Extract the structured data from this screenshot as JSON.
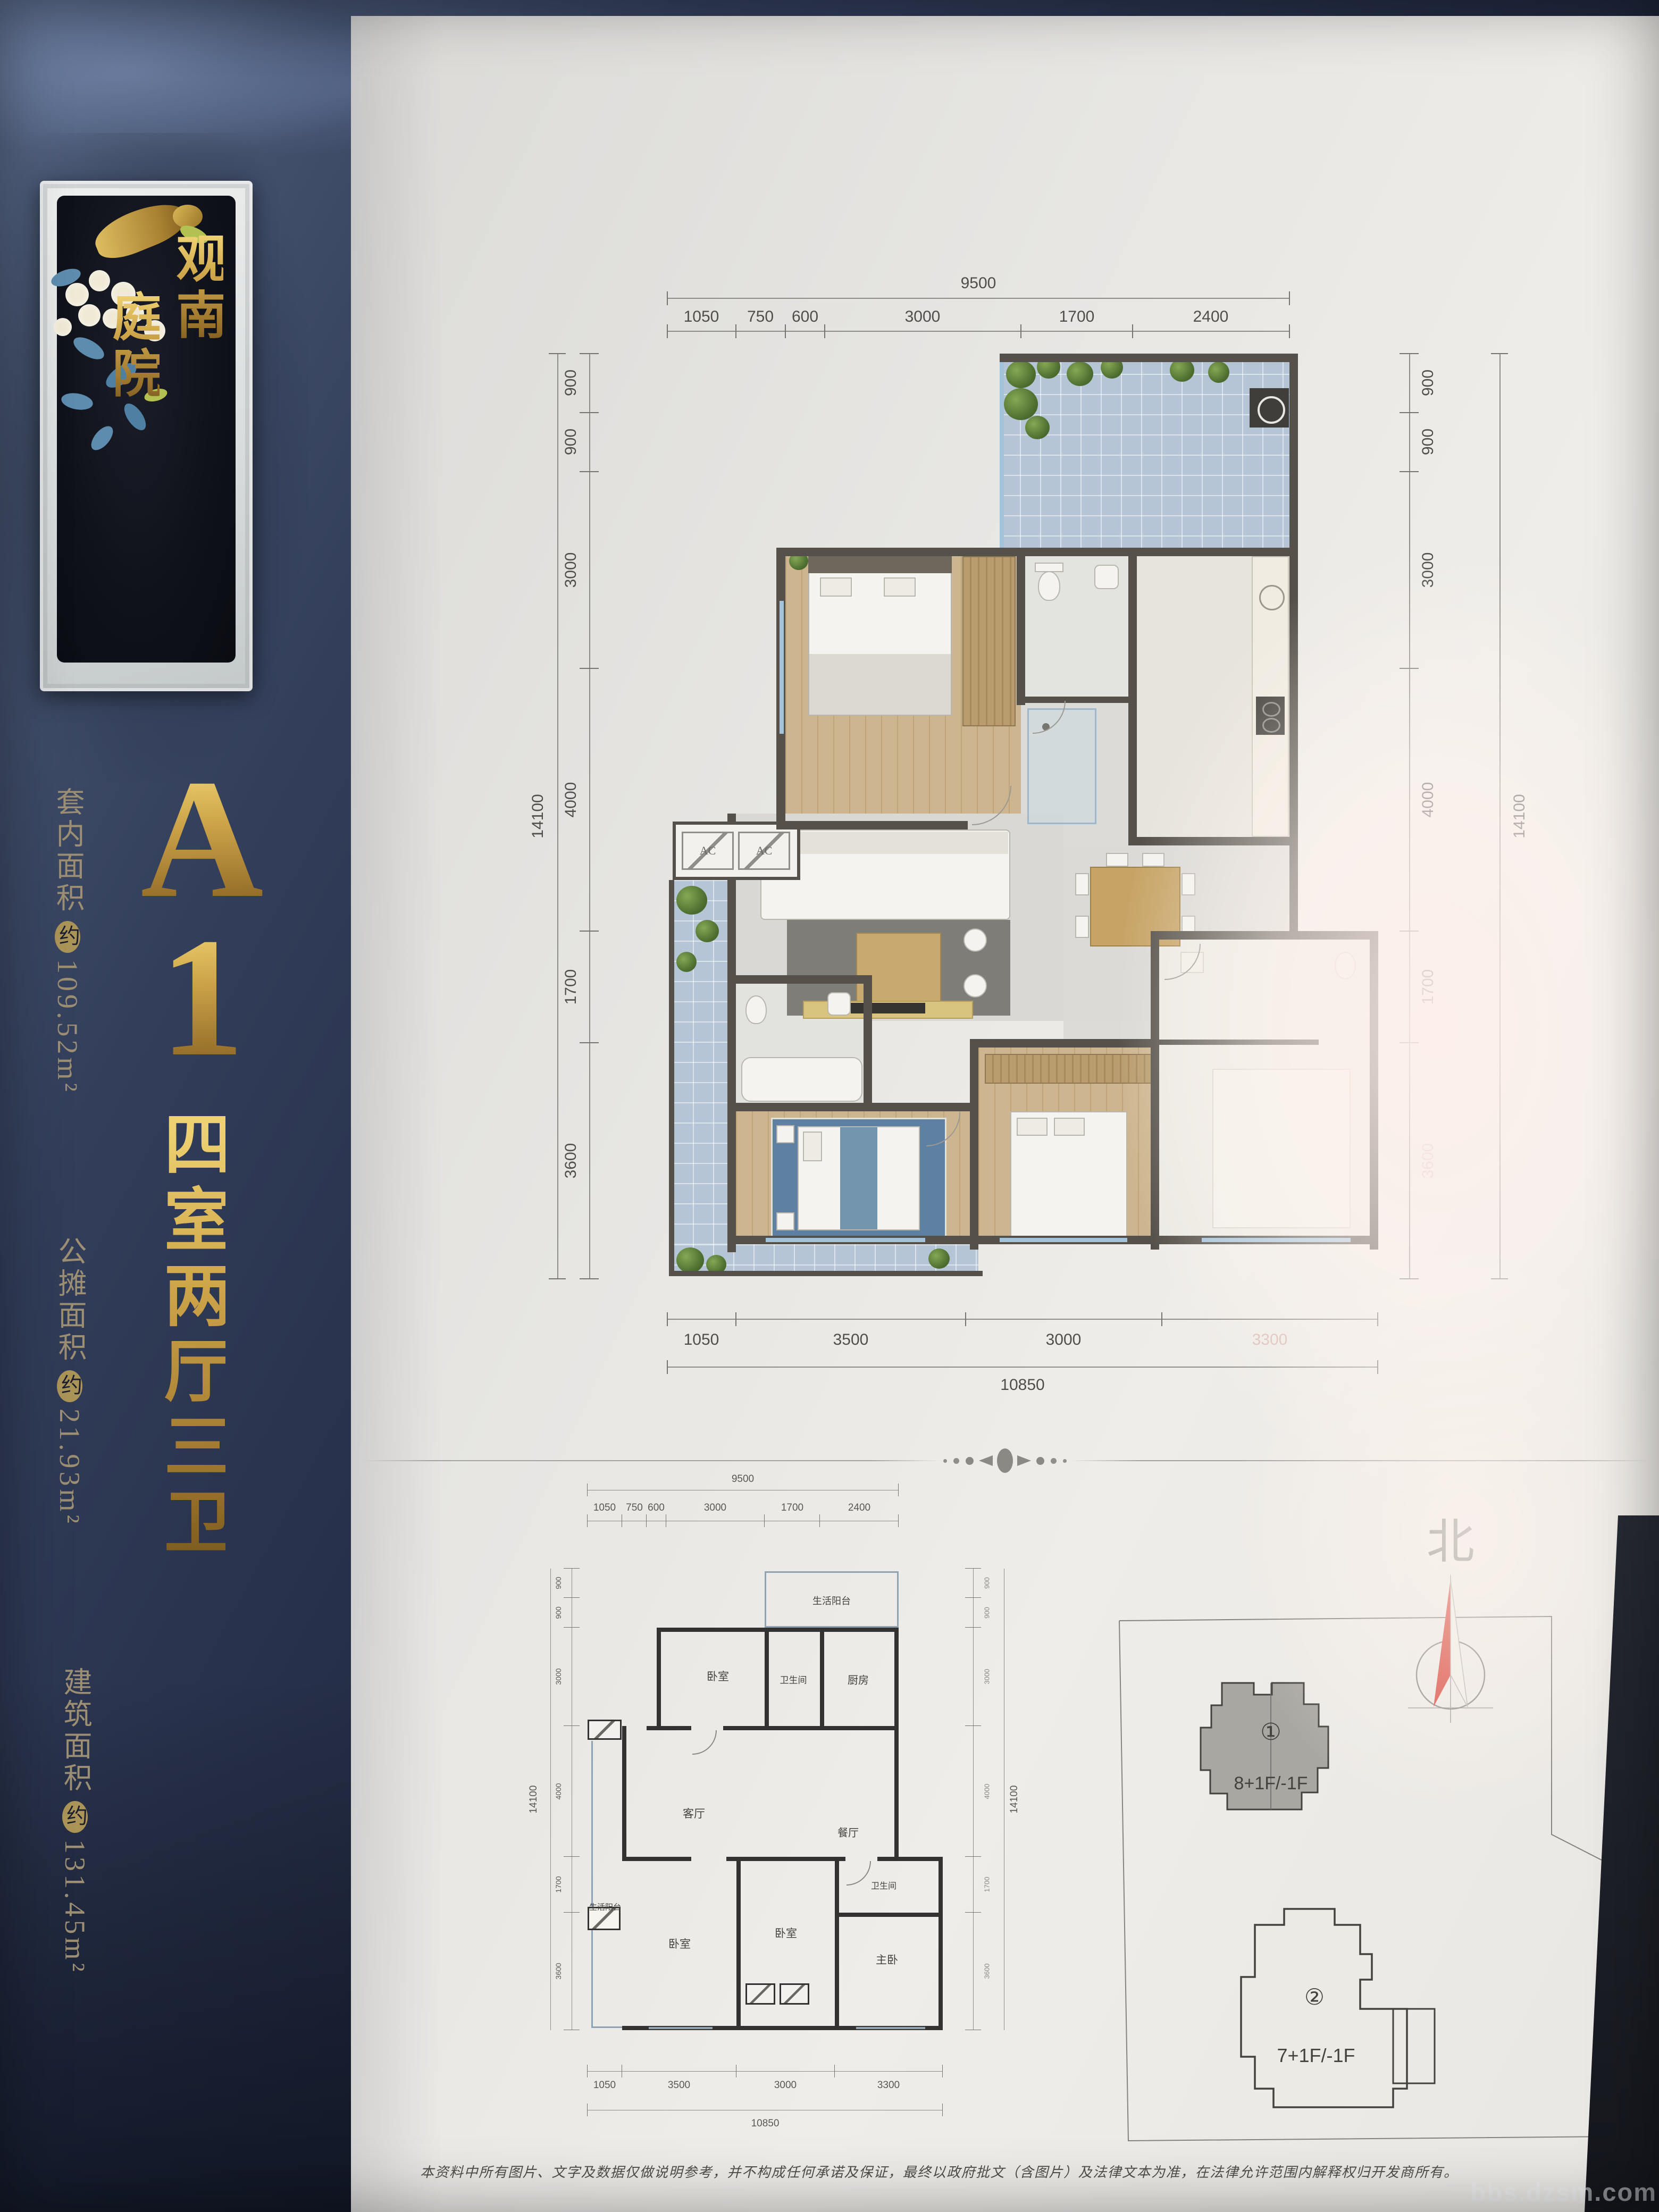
{
  "banner": {
    "plaque_title": "观南庭院",
    "plaque_col_right": "观南",
    "plaque_col_left": "庭院",
    "unit_letter": "A",
    "unit_number": "1",
    "layout": "四室两厅三卫",
    "areas": [
      {
        "label": "套内面积",
        "approx": "约",
        "value": "109.52m²"
      },
      {
        "label": "公摊面积",
        "approx": "约",
        "value": "21.93m²"
      },
      {
        "label": "建筑面积",
        "approx": "约",
        "value": "131.45m²"
      }
    ]
  },
  "dims": {
    "top_total": "9500",
    "top_segments": [
      "1050",
      "750",
      "600",
      "3000",
      "1700",
      "2400"
    ],
    "side_total": "14100",
    "side_segments": [
      "900",
      "900",
      "3000",
      "4000",
      "1700",
      "3600"
    ],
    "bottom_total": "10850",
    "bottom_segments": [
      "1050",
      "3500",
      "3000",
      "3300"
    ]
  },
  "main_plan": {
    "ac_label": "AC"
  },
  "small_plan": {
    "rooms": {
      "terrace_top": "生活阳台",
      "bedroom_top": "卧室",
      "bath_top": "卫生间",
      "kitchen": "厨房",
      "living": "客厅",
      "balcony_left": "生活阳台",
      "dining": "餐厅",
      "bath_bottom": "卫生间",
      "bedroom_bl": "卧室",
      "bedroom_bc": "卧室",
      "master": "主卧"
    }
  },
  "site_plan": {
    "north": "北",
    "building_1": {
      "tag": "①",
      "floors": "8+1F/-1F"
    },
    "building_2": {
      "tag": "②",
      "floors": "7+1F/-1F"
    }
  },
  "footer": {
    "disclaimer": "本资料中所有图片、文字及数据仅做说明参考，并不构成任何承诺及保证，最终以政府批文（含图片）及法律文本为准，在法律允许范围内解释权归开发商所有。"
  },
  "watermark": {
    "text": "bbs.dzsm.com"
  }
}
